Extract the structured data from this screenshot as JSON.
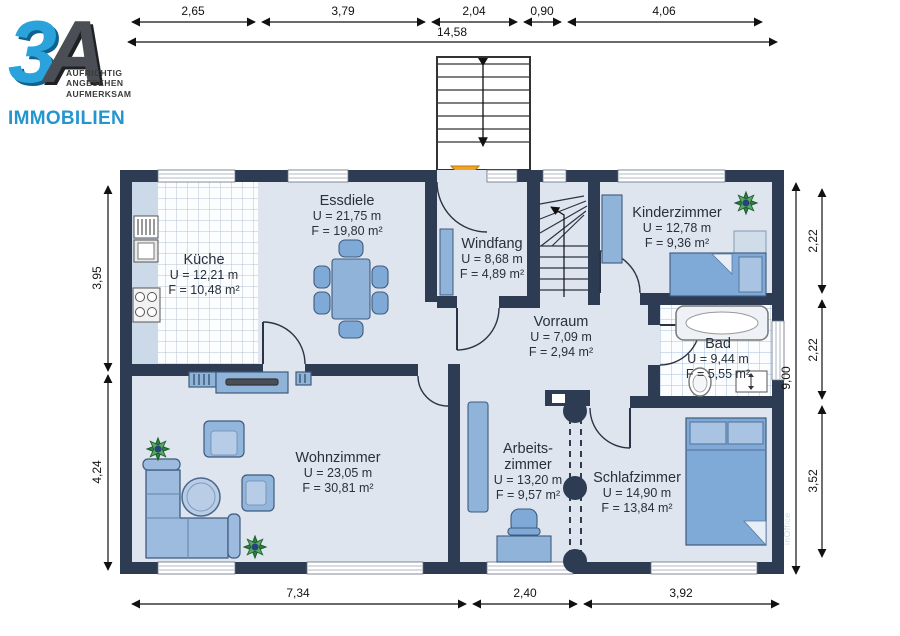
{
  "logo": {
    "mark_3": "3",
    "mark_a": "A",
    "taglines": [
      "AUFRICHTIG",
      "ANGESEHEN",
      "AUFMERKSAM"
    ],
    "brand": "IMMOBILIEN"
  },
  "watermark": "inOffice",
  "rooms": [
    {
      "id": "kueche",
      "name": "Küche",
      "u": "U = 12,21 m",
      "f": "F = 10,48 m²"
    },
    {
      "id": "essdiele",
      "name": "Essdiele",
      "u": "U = 21,75 m",
      "f": "F = 19,80 m²"
    },
    {
      "id": "windfang",
      "name": "Windfang",
      "u": "U = 8,68 m",
      "f": "F = 4,89 m²"
    },
    {
      "id": "kinderzimmer",
      "name": "Kinderzimmer",
      "u": "U = 12,78 m",
      "f": "F = 9,36 m²"
    },
    {
      "id": "vorraum",
      "name": "Vorraum",
      "u": "U = 7,09 m",
      "f": "F = 2,94 m²"
    },
    {
      "id": "bad",
      "name": "Bad",
      "u": "U = 9,44 m",
      "f": "F = 5,55 m²"
    },
    {
      "id": "wohnzimmer",
      "name": "Wohnzimmer",
      "u": "U = 23,05 m",
      "f": "F = 30,81 m²"
    },
    {
      "id": "arbeitszimmer",
      "name": "Arbeits-",
      "name2": "zimmer",
      "u": "U = 13,20 m",
      "f": "F = 9,57 m²"
    },
    {
      "id": "schlafzimmer",
      "name": "Schlafzimmer",
      "u": "U = 14,90 m",
      "f": "F = 13,84 m²"
    }
  ],
  "dimensions": {
    "top": [
      "2,65",
      "3,79",
      "2,04",
      "0,90",
      "4,06"
    ],
    "top_total": "14,58",
    "left": [
      "3,95",
      "4,24"
    ],
    "right": [
      "2,22",
      "2,22",
      "3,52"
    ],
    "right_total": "9,00",
    "bottom": [
      "7,34",
      "2,40",
      "3,92"
    ]
  },
  "colors": {
    "wall": "#2d3c52",
    "floor": "#dfe5ee",
    "furniture": "#8fb3d9",
    "logo_blue": "#2aa3dc",
    "entrance_arrow": "#f5a31f"
  }
}
